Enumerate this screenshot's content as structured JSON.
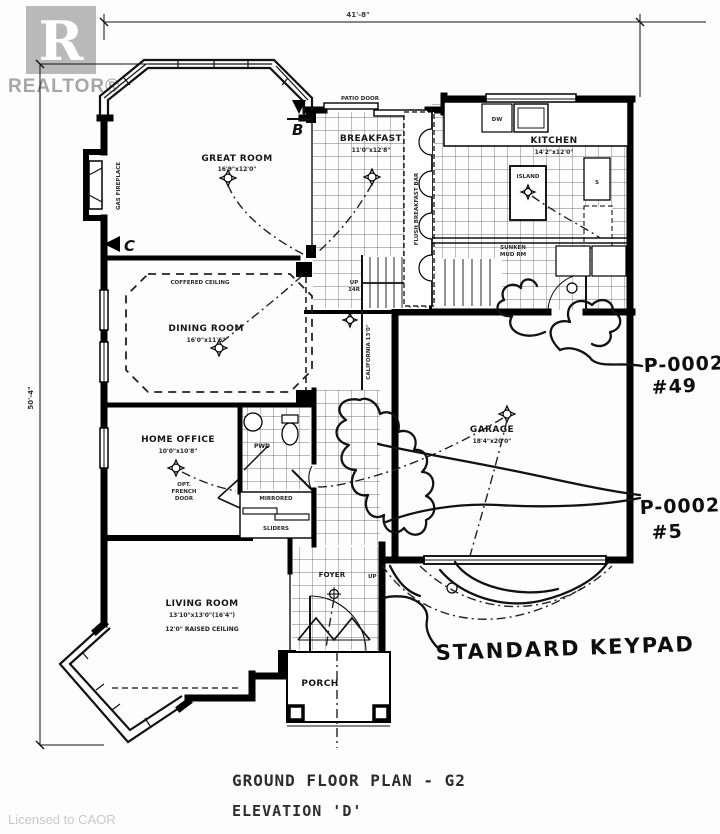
{
  "branding": {
    "logo_letter": "R",
    "realtor": "REALTOR®",
    "license": "Licensed to CAOR"
  },
  "dimensions": {
    "top": "41'-8\"",
    "left": "50'-4\""
  },
  "markers": {
    "section_b": "B",
    "section_c": "C"
  },
  "rooms": {
    "great_room": {
      "name": "GREAT ROOM",
      "size": "16'9\"x12'0\""
    },
    "breakfast": {
      "name": "BREAKFAST",
      "size": "11'0\"x12'8\""
    },
    "kitchen": {
      "name": "KITCHEN",
      "size": "14'2\"x12'0\""
    },
    "dining": {
      "name": "DINING ROOM",
      "size": "16'0\"x11'6\""
    },
    "office": {
      "name": "HOME OFFICE",
      "size": "10'0\"x10'8\""
    },
    "living": {
      "name": "LIVING ROOM",
      "size": "13'10\"x13'0\"(16'4\")",
      "ceiling": "12'0\" RAISED CEILING"
    },
    "garage": {
      "name": "GARAGE",
      "size": "18'4\"x20'0\""
    },
    "foyer": {
      "name": "FOYER"
    },
    "porch": {
      "name": "PORCH"
    },
    "powder": {
      "name": "PWD"
    },
    "mud": {
      "line1": "SUNKEN",
      "line2": "MUD RM"
    }
  },
  "features": {
    "patio_door": "PATIO DOOR",
    "gas_fireplace": "GAS FIREPLACE",
    "coffered_ceiling": "COFFERED CEILING",
    "flush_breakfast_bar": "FLUSH BREAKFAST BAR",
    "island": "ISLAND",
    "dw": "DW",
    "s": "S",
    "up": "UP",
    "risers": "14R",
    "california": "CALIFORNIA 13'0\"",
    "mirrored_l1": "MIRRORED",
    "mirrored_l2": "SLIDERS",
    "opt_l1": "OPT.",
    "opt_l2": "FRENCH",
    "opt_l3": "DOOR"
  },
  "annotations": {
    "keypad": "STANDARD KEYPAD",
    "tag49_l1": "P-0002",
    "tag49_l2": "#49",
    "tag5_l1": "P-0002",
    "tag5_l2": "#5"
  },
  "footer": {
    "title": "GROUND FLOOR PLAN - G2",
    "elevation": "ELEVATION 'D'"
  }
}
